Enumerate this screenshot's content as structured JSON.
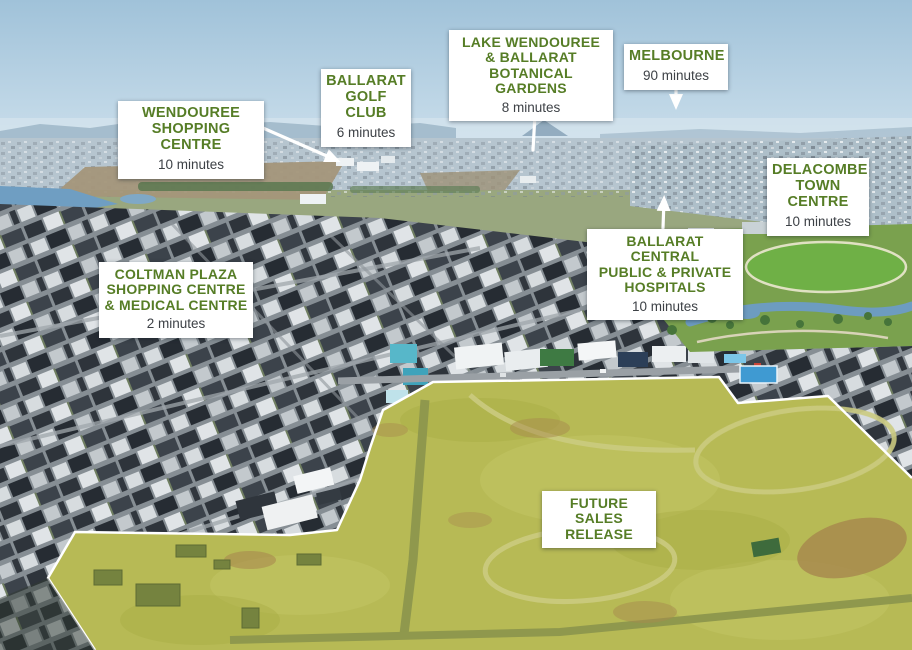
{
  "colors": {
    "label_title": "#567d26",
    "label_minutes": "#3d4146",
    "label_bg": "#ffffff",
    "arrow": "#ffffff",
    "highlight_fill": "#b7ba55",
    "highlight_border": "#ffffff"
  },
  "labels": [
    {
      "id": "wendouree-shopping-centre",
      "title": "WENDOUREE\nSHOPPING CENTRE",
      "minutes": "10 minutes",
      "pointer": "arrow-down-right"
    },
    {
      "id": "ballarat-golf-club",
      "title": "BALLARAT\nGOLF CLUB",
      "minutes": "6 minutes",
      "pointer": "arrow-down-right"
    },
    {
      "id": "lake-wendouree-botanical-gardens",
      "title": "LAKE WENDOUREE\n& BALLARAT\nBOTANICAL GARDENS",
      "minutes": "8 minutes",
      "pointer": "line-down"
    },
    {
      "id": "melbourne",
      "title": "MELBOURNE",
      "minutes": "90 minutes",
      "pointer": "arrow-down"
    },
    {
      "id": "delacombe-town-centre",
      "title": "DELACOMBE\nTOWN\nCENTRE",
      "minutes": "10 minutes",
      "pointer": "none"
    },
    {
      "id": "ballarat-central-hospitals",
      "title": "BALLARAT CENTRAL\nPUBLIC & PRIVATE\nHOSPITALS",
      "minutes": "10 minutes",
      "pointer": "arrow-up"
    },
    {
      "id": "coltman-plaza",
      "title": "COLTMAN PLAZA\nSHOPPING CENTRE\n& MEDICAL CENTRE",
      "minutes": "2 minutes",
      "pointer": "none"
    },
    {
      "id": "future-sales-release",
      "title": "FUTURE SALES\nRELEASE",
      "minutes": "",
      "pointer": "none"
    }
  ]
}
